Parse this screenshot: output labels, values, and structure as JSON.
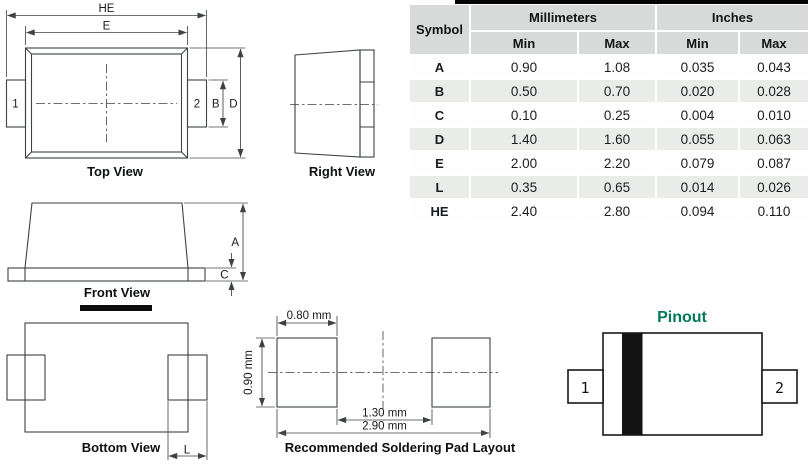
{
  "table": {
    "headers": {
      "symbol": "Symbol",
      "millimeters": "Millimeters",
      "inches": "Inches",
      "min": "Min",
      "max": "Max"
    },
    "rows": [
      {
        "symbol": "A",
        "mm_min": "0.90",
        "mm_max": "1.08",
        "in_min": "0.035",
        "in_max": "0.043"
      },
      {
        "symbol": "B",
        "mm_min": "0.50",
        "mm_max": "0.70",
        "in_min": "0.020",
        "in_max": "0.028"
      },
      {
        "symbol": "C",
        "mm_min": "0.10",
        "mm_max": "0.25",
        "in_min": "0.004",
        "in_max": "0.010"
      },
      {
        "symbol": "D",
        "mm_min": "1.40",
        "mm_max": "1.60",
        "in_min": "0.055",
        "in_max": "0.063"
      },
      {
        "symbol": "E",
        "mm_min": "2.00",
        "mm_max": "2.20",
        "in_min": "0.079",
        "in_max": "0.087"
      },
      {
        "symbol": "L",
        "mm_min": "0.35",
        "mm_max": "0.65",
        "in_min": "0.014",
        "in_max": "0.026"
      },
      {
        "symbol": "HE",
        "mm_min": "2.40",
        "mm_max": "2.80",
        "in_min": "0.094",
        "in_max": "0.110"
      }
    ]
  },
  "views": {
    "top": {
      "label": "Top View",
      "dim_he": "HE",
      "dim_e": "E",
      "dim_b": "B",
      "dim_d": "D",
      "pin1": "1",
      "pin2": "2"
    },
    "right": {
      "label": "Right View"
    },
    "front": {
      "label": "Front View",
      "dim_a": "A",
      "dim_c": "C"
    },
    "bottom": {
      "label": "Bottom View",
      "dim_l": "L"
    },
    "pad_layout": {
      "label": "Recommended Soldering Pad Layout",
      "dim_pad_width": "0.80 mm",
      "dim_pad_height": "0.90 mm",
      "dim_inner_gap": "1.30 mm",
      "dim_overall": "2.90 mm"
    },
    "pinout": {
      "title": "Pinout",
      "pin1": "1",
      "pin2": "2"
    }
  },
  "colors": {
    "pinout_title": "#007A5A",
    "table_header_bg": "#D7DAD8",
    "table_stripe_bg": "#E9ECE9",
    "drawing_line": "#3D4242",
    "cathode_band": "#131313"
  }
}
